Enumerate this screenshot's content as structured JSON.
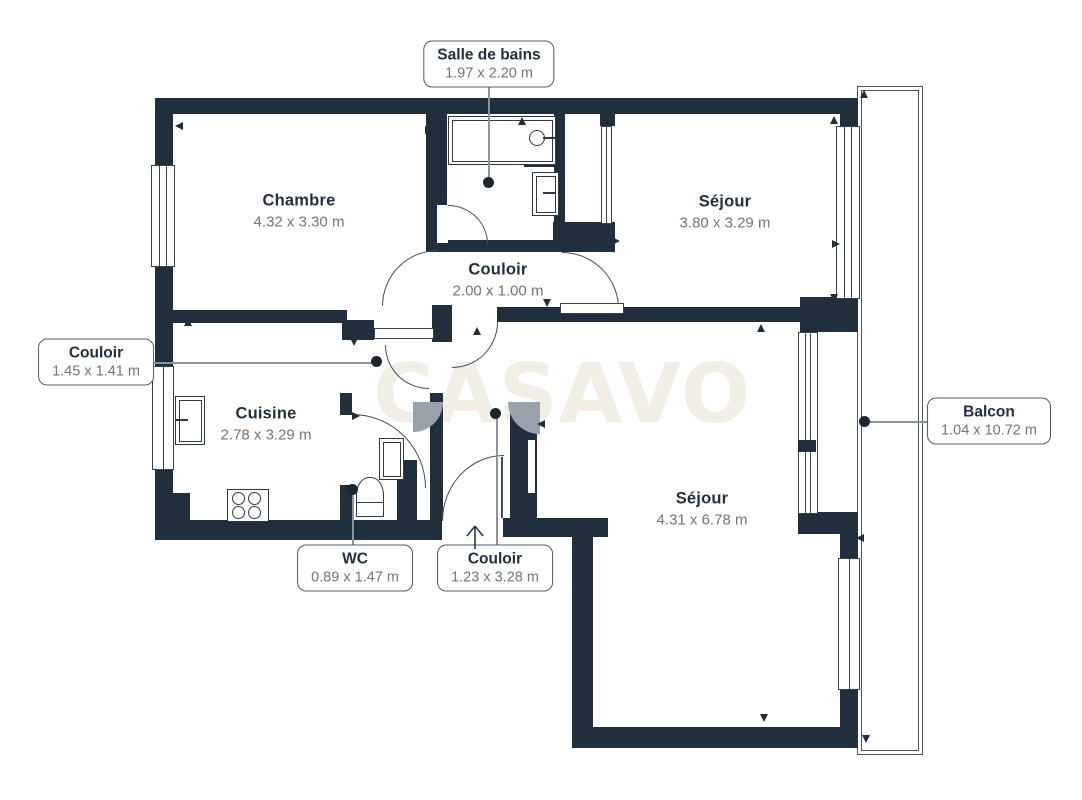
{
  "watermark": "CASAVO",
  "colors": {
    "wall": "#212e3c",
    "fixture": "#2e3947",
    "arc": "#454d57",
    "fan": "#99a1ab",
    "window_line": "#39424e",
    "balcony_line": "#4a525c",
    "label_text": "#22303e",
    "dims_text": "#6e757e",
    "label_border": "#535a64",
    "leader": "#8d939b",
    "dot": "#1d252e",
    "watermark": "#f1eee6"
  },
  "rooms": {
    "chambre": {
      "name": "Chambre",
      "dims": "4.32 x 3.30 m"
    },
    "sejour_haut": {
      "name": "Séjour",
      "dims": "3.80 x 3.29 m"
    },
    "couloir_central": {
      "name": "Couloir",
      "dims": "2.00 x 1.00 m"
    },
    "cuisine": {
      "name": "Cuisine",
      "dims": "2.78 x 3.29 m"
    },
    "sejour_bas": {
      "name": "Séjour",
      "dims": "4.31 x 6.78 m"
    }
  },
  "callouts": {
    "salle_de_bains": {
      "name": "Salle de bains",
      "dims": "1.97 x 2.20 m"
    },
    "couloir_ouest": {
      "name": "Couloir",
      "dims": "1.45 x 1.41 m"
    },
    "wc": {
      "name": "WC",
      "dims": "0.89 x 1.47 m"
    },
    "couloir_entree": {
      "name": "Couloir",
      "dims": "1.23 x 3.28 m"
    },
    "balcon": {
      "name": "Balcon",
      "dims": "1.04 x 10.72 m"
    }
  },
  "icons": {
    "entry_arrow": "up-arrow"
  }
}
